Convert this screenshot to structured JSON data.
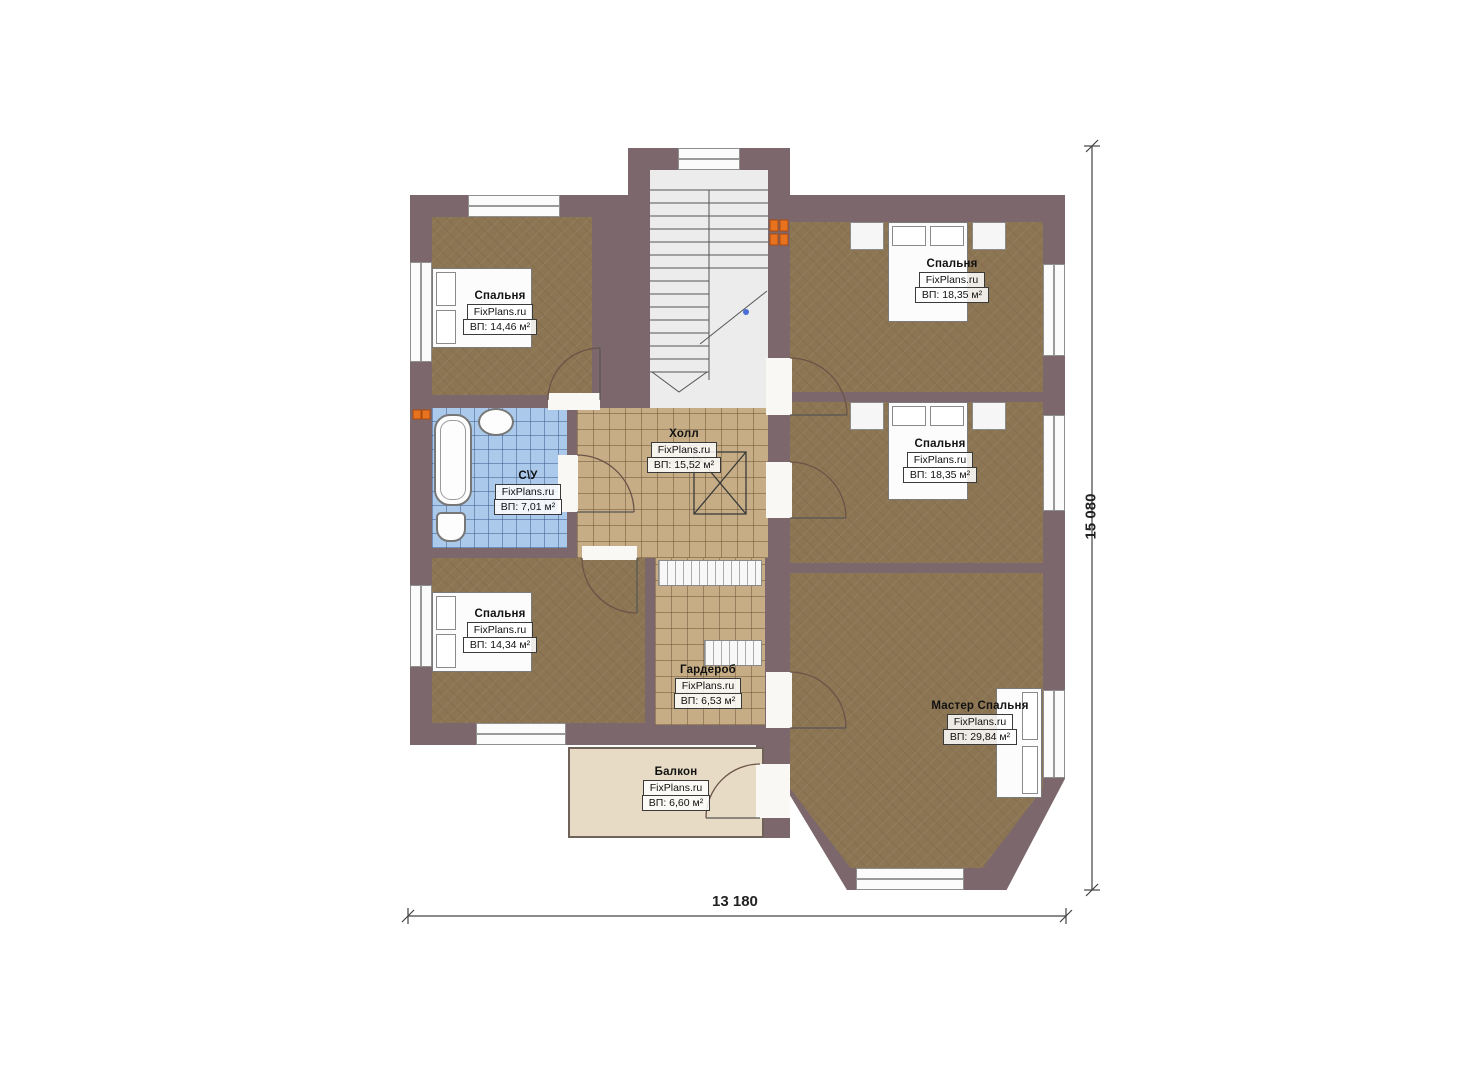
{
  "plan": {
    "rooms": [
      {
        "key": "bedroom-top-left",
        "name": "Спальня",
        "brand": "FixPlans.ru",
        "area": "ВП: 14,46 м²"
      },
      {
        "key": "bedroom-top-right",
        "name": "Спальня",
        "brand": "FixPlans.ru",
        "area": "ВП: 18,35 м²"
      },
      {
        "key": "bedroom-mid-right",
        "name": "Спальня",
        "brand": "FixPlans.ru",
        "area": "ВП: 18,35 м²"
      },
      {
        "key": "bathroom",
        "name": "С\\У",
        "brand": "FixPlans.ru",
        "area": "ВП: 7,01 м²"
      },
      {
        "key": "hall",
        "name": "Холл",
        "brand": "FixPlans.ru",
        "area": "ВП: 15,52 м²"
      },
      {
        "key": "bedroom-bottom-left",
        "name": "Спальня",
        "brand": "FixPlans.ru",
        "area": "ВП: 14,34 м²"
      },
      {
        "key": "wardrobe",
        "name": "Гардероб",
        "brand": "FixPlans.ru",
        "area": "ВП: 6,53 м²"
      },
      {
        "key": "master-bedroom",
        "name": "Мастер Спальня",
        "brand": "FixPlans.ru",
        "area": "ВП: 29,84 м²"
      },
      {
        "key": "balcony",
        "name": "Балкон",
        "brand": "FixPlans.ru",
        "area": "ВП: 6,60 м²"
      }
    ],
    "dimensions": {
      "width": "13 180",
      "height": "15 080"
    },
    "colors": {
      "wall": "#7c686c",
      "carpet": "#8c7553",
      "hall_tile": "#c6ad85",
      "bath_tile": "#abc9eb",
      "balcony": "#e7dbc5",
      "stairs": "#ececec",
      "radiator": "#e8731e"
    }
  }
}
